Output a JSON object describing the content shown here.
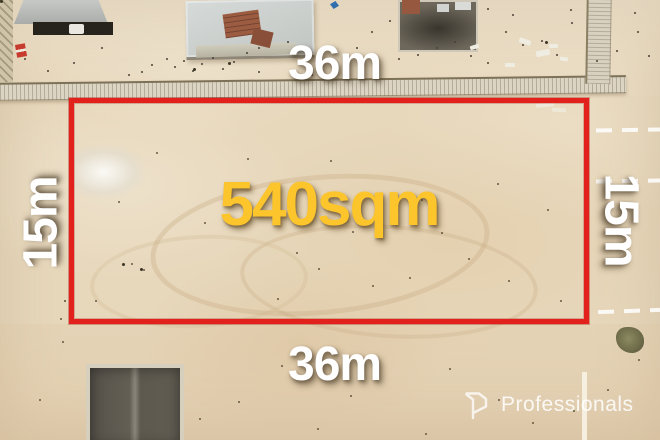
{
  "annotations": {
    "area": "540sqm",
    "top_width": "36m",
    "bottom_width": "36m",
    "left_depth": "15m",
    "right_depth": "15m"
  },
  "watermark": {
    "brand": "Professionals",
    "icon": "professionals-p-logo"
  },
  "colors": {
    "boundary_red": "#e3211c",
    "area_yellow": "#fdc52c",
    "dimension_white": "#ffffff",
    "sand_base": "#e7d7bb"
  }
}
